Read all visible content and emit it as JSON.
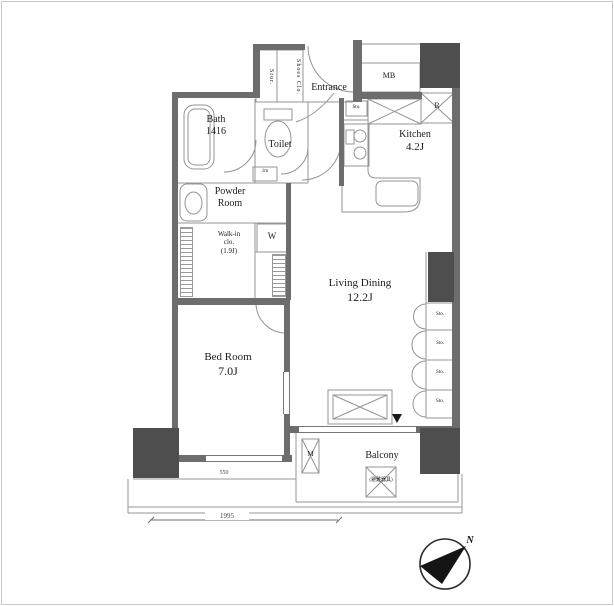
{
  "plan": {
    "rooms": {
      "bath": {
        "name": "Bath",
        "size": "1416"
      },
      "toilet": {
        "name": "Toilet"
      },
      "entrance": {
        "name": "Entrance"
      },
      "mb": {
        "name": "MB"
      },
      "refrigerator_mark": "R",
      "kitchen": {
        "name": "Kitchen",
        "size": "4.2J"
      },
      "powder_room": {
        "name_line1": "Powder",
        "name_line2": "Room"
      },
      "walk_in_closet": {
        "name_line1": "Walk-in",
        "name_line2": "clo.",
        "size": "(1.9J)"
      },
      "living_dining": {
        "name": "Living Dining",
        "size": "12.2J"
      },
      "bed_room": {
        "name": "Bed Room",
        "size": "7.0J"
      },
      "balcony": {
        "name": "Balcony"
      }
    },
    "storage": {
      "stor": "Stor.",
      "shoes_closet": "Shoes Clo.",
      "kitchen_sto": "Sto.",
      "wall_sto": [
        "Sto.",
        "Sto.",
        "Sto.",
        "Sto."
      ],
      "toilet_shelf": "1m"
    },
    "equipment": {
      "washer": "W",
      "meter": "M",
      "evacuation_hatch": "(避難器具)"
    },
    "dimensions": {
      "window_height": "550",
      "balcony_width": "1995"
    },
    "compass": {
      "north": "N"
    }
  }
}
